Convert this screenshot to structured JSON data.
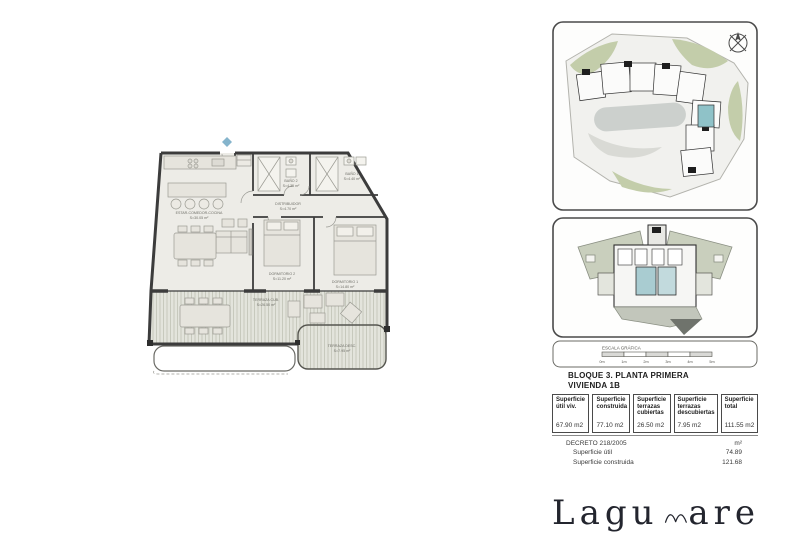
{
  "title": {
    "line1": "BLOQUE 3. PLANTA PRIMERA",
    "line2": "VIVIENDA 1B"
  },
  "floor_plan": {
    "rooms": [
      {
        "name": "ESTAR-COMEDOR-COCINA",
        "area": "S=30.05 m²"
      },
      {
        "name": "DISTRIBUIDOR",
        "area": "S=4.70 m²"
      },
      {
        "name": "BAÑO 2",
        "area": "S=4.35 m²"
      },
      {
        "name": "BAÑO 1",
        "area": "S=4.40 m²"
      },
      {
        "name": "DORMITORIO 2",
        "area": "S=11.20 m²"
      },
      {
        "name": "DORMITORIO 1",
        "area": "S=14.80 m²"
      },
      {
        "name": "TERRAZA CUB.",
        "area": "S=26.50 m²"
      },
      {
        "name": "TERRAZA DESC.",
        "area": "S=7.95 m²"
      }
    ]
  },
  "scale_bar": {
    "label": "ESCALA GRÁFICA",
    "ticks": [
      "0m",
      "1m",
      "2m",
      "3m",
      "4m",
      "5m"
    ]
  },
  "table": {
    "columns": [
      {
        "header": "Superficie útil viv.",
        "value": "67.90 m2"
      },
      {
        "header": "Superficie construida",
        "value": "77.10 m2"
      },
      {
        "header": "Superficie terrazas cubiertas",
        "value": "26.50 m2"
      },
      {
        "header": "Superficie terrazas descubiertas",
        "value": "7.95 m2"
      },
      {
        "header": "Superficie total",
        "value": "111.55 m2"
      }
    ]
  },
  "decreto": {
    "title": "DECRETO 218/2005",
    "unit": "m²",
    "rows": [
      {
        "label": "Superficie útil",
        "value": "74.89"
      },
      {
        "label": "Superficie construida",
        "value": "121.68"
      }
    ]
  },
  "logo": {
    "text_left": "Lagu",
    "text_right": "are"
  },
  "colors": {
    "highlight_teal": "#8fc2c8",
    "wall": "#3c3c3c",
    "site_green": "#c3cdaa",
    "terrace_fill": "#e3e4dc",
    "logo_ink": "#23252e"
  }
}
